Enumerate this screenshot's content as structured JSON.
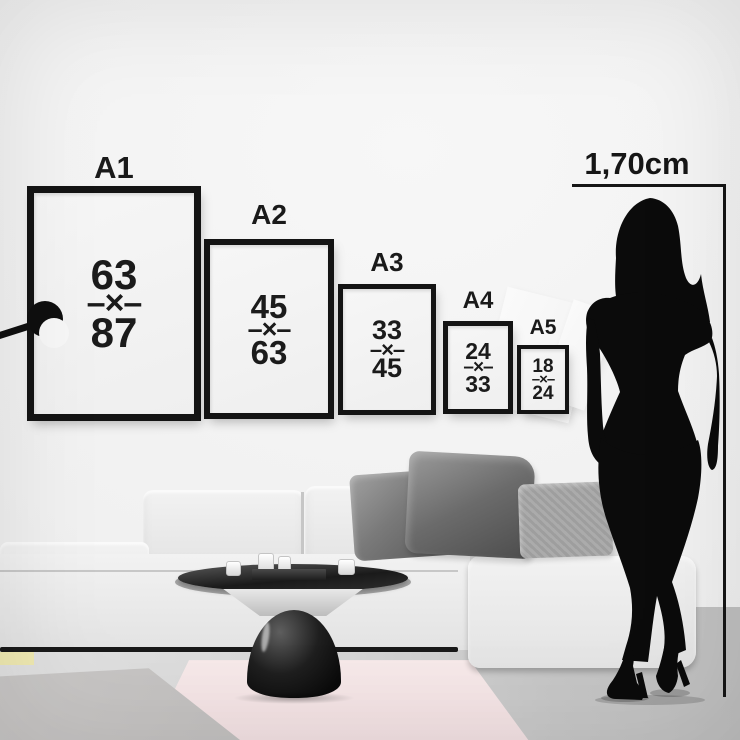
{
  "title": "Poster size comparison wall chart",
  "frames": [
    {
      "id": "a1",
      "label": "A1",
      "width_value": "63",
      "separator": "–×–",
      "height_value": "87"
    },
    {
      "id": "a2",
      "label": "A2",
      "width_value": "45",
      "separator": "–×–",
      "height_value": "63"
    },
    {
      "id": "a3",
      "label": "A3",
      "width_value": "33",
      "separator": "–×–",
      "height_value": "45"
    },
    {
      "id": "a4",
      "label": "A4",
      "width_value": "24",
      "separator": "–×–",
      "height_value": "33"
    },
    {
      "id": "a5",
      "label": "A5",
      "width_value": "18",
      "separator": "–×–",
      "height_value": "24"
    }
  ],
  "measure": {
    "label": "1,70cm"
  },
  "colors": {
    "frame_border": "#141414",
    "wall": "#f1f1f1",
    "floor": "#cfcfcf",
    "rug_pink": "#f2e0e2",
    "rug_gray": "#c7c5c4",
    "rug_yellow": "#f0eab2",
    "silhouette": "#0b0b0b",
    "pillow_dark": "#6b6b6b",
    "pillow_light": "#a6a6a6",
    "sofa": "#ececec"
  }
}
